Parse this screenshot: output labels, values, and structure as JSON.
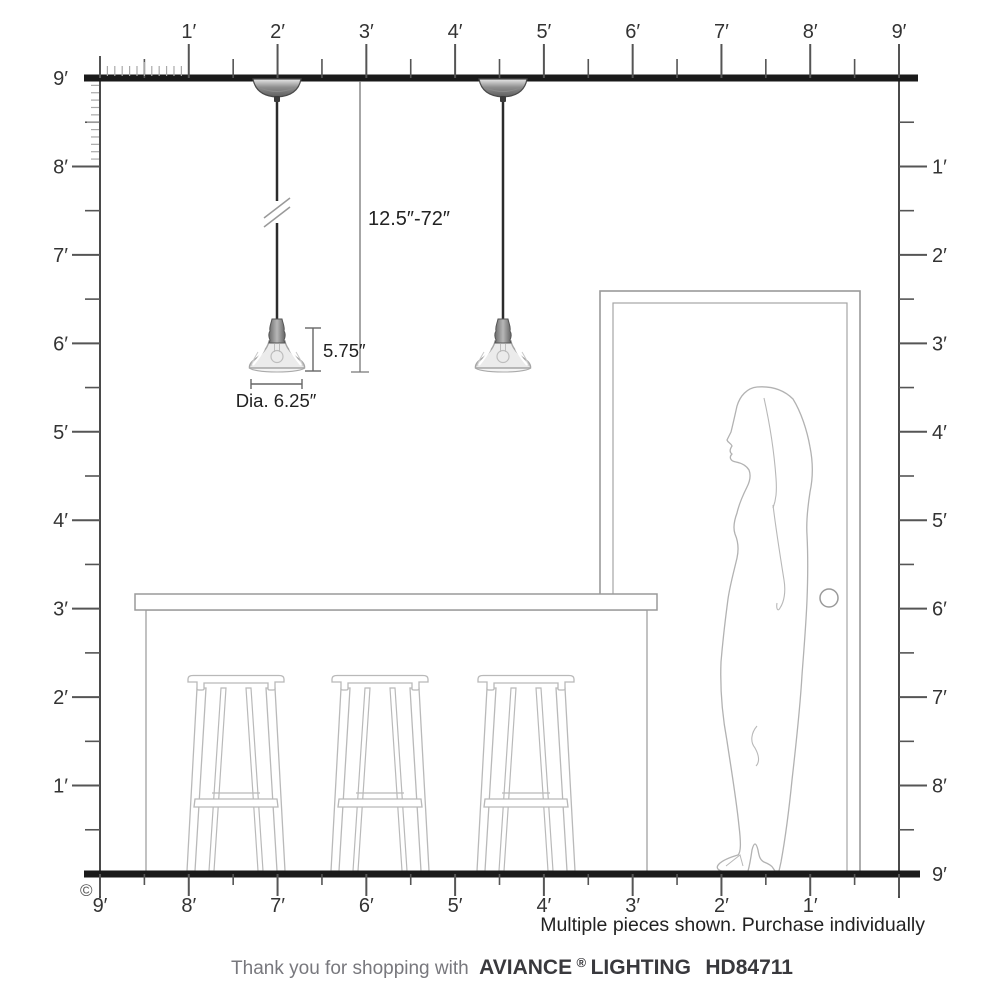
{
  "page": {
    "copyright_symbol": "©",
    "note": "Multiple pieces shown. Purchase individually",
    "footer": {
      "prefix": "Thank you for shopping with",
      "brand_name": "AVIANCE",
      "registered_mark": "®",
      "brand_suffix": "LIGHTING",
      "model_number": "HD84711"
    }
  },
  "dimensions": {
    "cord_length": "12.5″-72″",
    "shade_height": "5.75″",
    "shade_diameter": "Dia. 6.25″"
  },
  "rulers": {
    "top": {
      "labels": [
        "1′",
        "2′",
        "3′",
        "4′",
        "5′",
        "6′",
        "7′",
        "8′",
        "9′"
      ]
    },
    "left": {
      "labels": [
        "9′",
        "8′",
        "7′",
        "6′",
        "5′",
        "4′",
        "3′",
        "2′",
        "1′"
      ]
    },
    "right": {
      "labels": [
        "1′",
        "2′",
        "3′",
        "4′",
        "5′",
        "6′",
        "7′",
        "8′",
        "9′"
      ]
    },
    "bottom": {
      "labels": [
        "9′",
        "8′",
        "7′",
        "6′",
        "5′",
        "4′",
        "3′",
        "2′",
        "1′"
      ]
    }
  },
  "colors": {
    "structure_line": "#1a1a1a",
    "ruler_tick": "#555555",
    "ruler_label": "#333333",
    "drawing_outline": "#b0b0b0",
    "metal_fixture": "#8f8f8f",
    "dimension_line": "#777777",
    "footer_muted": "#78787d",
    "footer_brand": "#39393d"
  }
}
